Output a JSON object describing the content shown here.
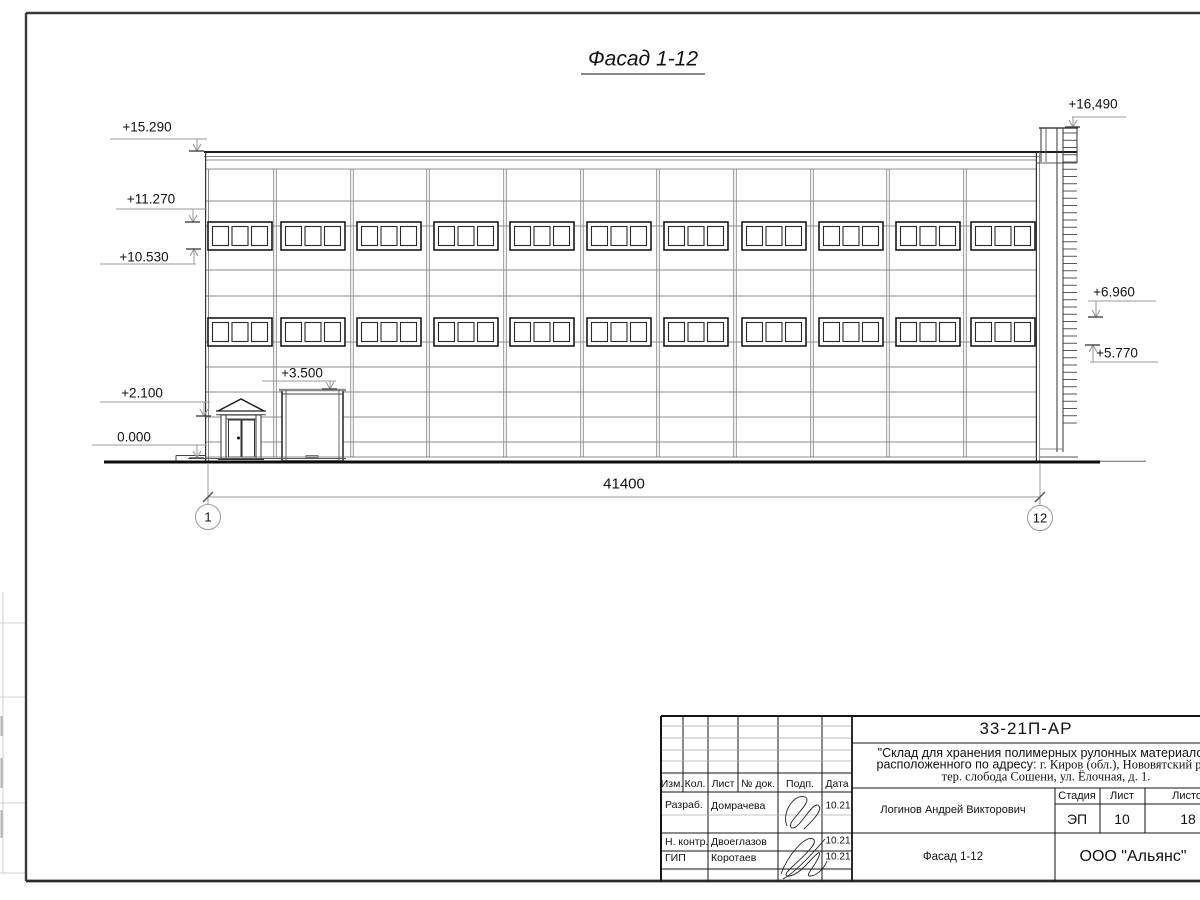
{
  "drawing": {
    "view_title": "Фасад 1-12",
    "dimension_total": "41400",
    "axis_left": "1",
    "axis_right": "12",
    "marks": {
      "m15_290": "+15.290",
      "m11_270": "+11.270",
      "m10_530": "+10.530",
      "m2_100": "+2.100",
      "m0_000": "0.000",
      "m3_500": "+3.500",
      "m16_490": "+16,490",
      "m6_960": "+6.960",
      "m5_770": "+5.770"
    }
  },
  "title_block": {
    "doc_code": "33-21П-АР",
    "project_line1": "\"Склад для хранения полимерных рулонных материалов\"",
    "project_line2_sans": "расположенного по адресу: ",
    "project_line2_serif": "г. Киров (обл.), Нововятский р-н,",
    "project_line3": "тер. слобода Сошени, ул. Ёлочная, д. 1.",
    "columns": {
      "izm": "Изм.",
      "kol": "Кол.",
      "list": "Лист",
      "doc": "№ док.",
      "sign": "Подп.",
      "date": "Дата"
    },
    "rows": [
      {
        "role": "Разраб.",
        "name": "Домрачева",
        "date": "10.21"
      },
      {
        "role": "Н. контр.",
        "name": "Двоеглазов",
        "date": "10.21"
      },
      {
        "role": "ГИП",
        "name": "Коротаев",
        "date": "10.21"
      }
    ],
    "approver": "Логинов Андрей Викторович",
    "stage_header": "Стадия",
    "sheet_header": "Лист",
    "sheets_header": "Листов",
    "stage": "ЭП",
    "sheet_number": "10",
    "sheets_total": "18",
    "drawing_name": "Фасад 1-12",
    "company": "ООО \"Альянс\""
  }
}
